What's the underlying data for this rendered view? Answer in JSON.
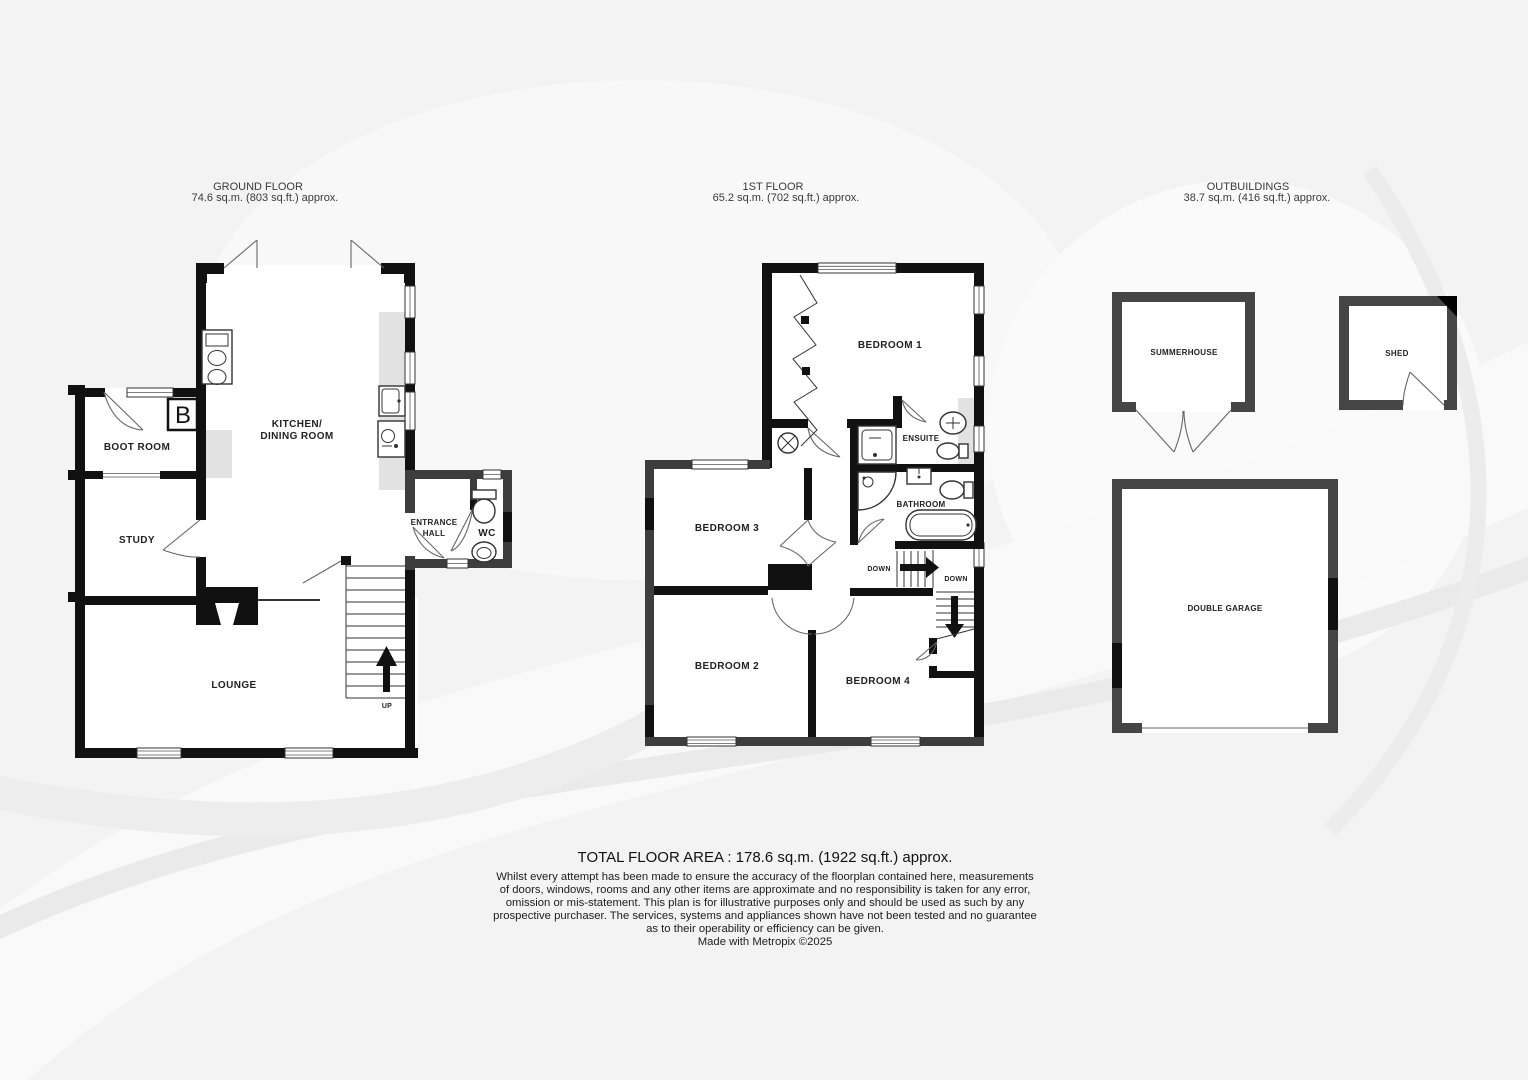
{
  "ground_floor": {
    "title": "GROUND FLOOR",
    "area": "74.6 sq.m. (803 sq.ft.) approx.",
    "rooms": {
      "boot_room": "BOOT ROOM",
      "study": "STUDY",
      "kitchen_line1": "KITCHEN/",
      "kitchen_line2": "DINING ROOM",
      "entrance_line1": "ENTRANCE",
      "entrance_line2": "HALL",
      "wc": "WC",
      "lounge": "LOUNGE"
    },
    "labels": {
      "boiler": "B",
      "up": "UP"
    }
  },
  "first_floor": {
    "title": "1ST FLOOR",
    "area": "65.2 sq.m. (702 sq.ft.) approx.",
    "rooms": {
      "bedroom1": "BEDROOM 1",
      "ensuite": "ENSUITE",
      "bathroom": "BATHROOM",
      "bedroom3": "BEDROOM 3",
      "bedroom2": "BEDROOM 2",
      "bedroom4": "BEDROOM 4"
    },
    "labels": {
      "down": "DOWN"
    }
  },
  "outbuildings": {
    "title": "OUTBUILDINGS",
    "area": "38.7 sq.m. (416 sq.ft.) approx.",
    "rooms": {
      "summerhouse": "SUMMERHOUSE",
      "shed": "SHED",
      "double_garage": "DOUBLE GARAGE"
    }
  },
  "footer": {
    "total": "TOTAL FLOOR AREA : 178.6 sq.m. (1922 sq.ft.) approx.",
    "disclaimer": [
      "Whilst every attempt has been made to ensure the accuracy of the floorplan contained here, measurements",
      "of doors, windows, rooms and any other items are approximate and no responsibility is taken for any error,",
      "omission or mis-statement. This plan is for illustrative purposes only and should be used as such by any",
      "prospective purchaser. The services, systems and appliances shown have not been tested and no guarantee",
      "as to their operability or efficiency can be given."
    ],
    "made_with": "Made with Metropix ©2025"
  },
  "colors": {
    "background": "#f3f3f3",
    "wall": "#111111",
    "wall_gray": "#3d3d3d",
    "outbuilding_wall": "#454545",
    "room_fill": "#ffffff",
    "counter": "#e2e2e2"
  }
}
